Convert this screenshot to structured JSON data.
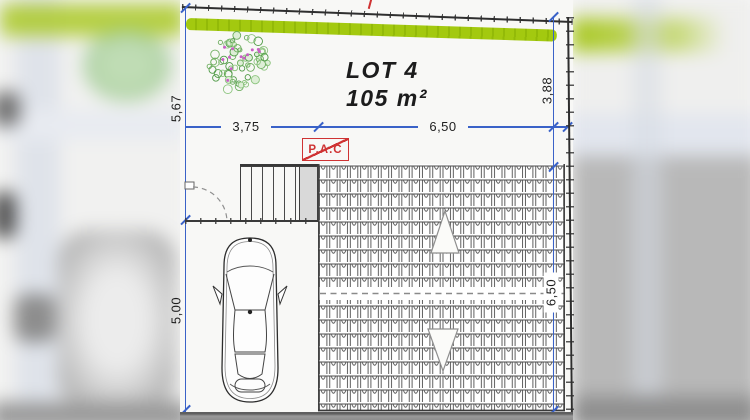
{
  "site_plan": {
    "lot": {
      "title": "LOT 4",
      "area": "105 m²"
    },
    "annotations": {
      "pac": "P.A.C"
    },
    "dimensions": {
      "left_upper": "5,67",
      "left_lower": "5,00",
      "width_left": "3,75",
      "width_right": "6,50",
      "right_upper": "3,88",
      "right_lower": "6,50"
    },
    "icons": {
      "tree": "tree-icon",
      "car": "car-icon",
      "roof_slope_up": "roof-slope-arrow-up-icon",
      "roof_slope_down": "roof-slope-arrow-down-icon"
    },
    "colors": {
      "hedge_green": "#a3c90f",
      "dimension_blue": "#3a62c8",
      "annotation_red": "#cf3333",
      "line_dark": "#3a3a3a"
    }
  }
}
